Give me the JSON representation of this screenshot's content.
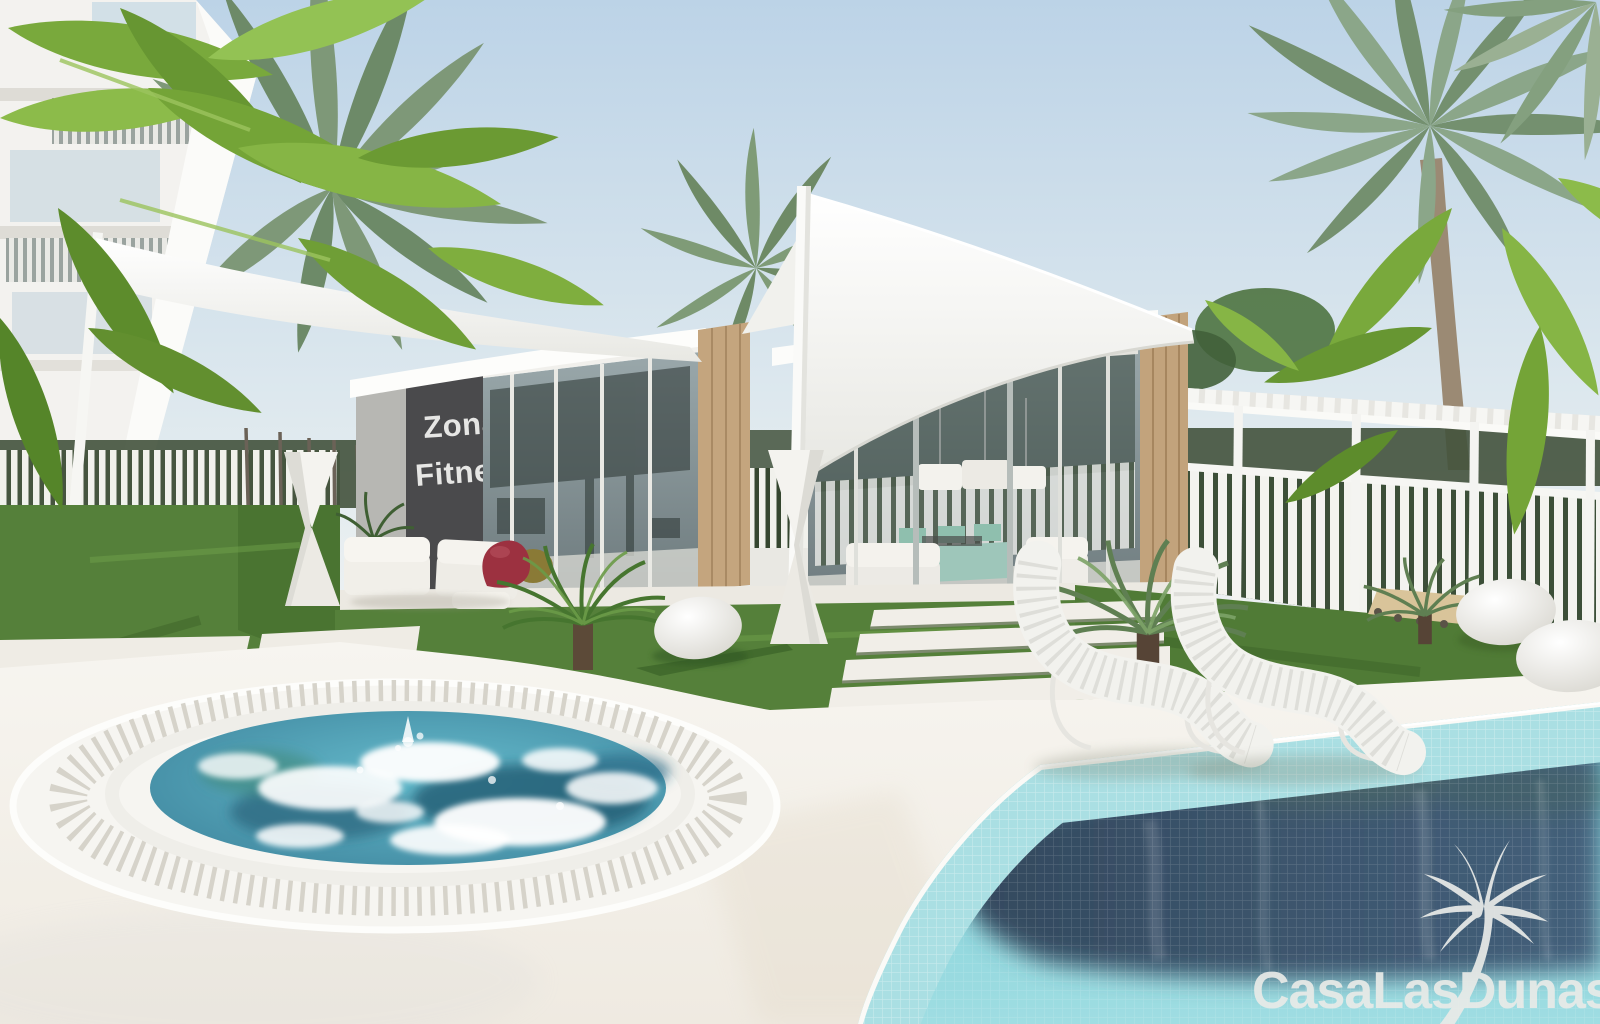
{
  "scene": {
    "description": "3D architectural render of a resort garden: modern glass pavilions with white sail canopies, palm trees, a bubbling round jacuzzi and a mosaic-tiled swimming pool",
    "elements": [
      "sky",
      "apartment-building",
      "banana-foliage",
      "palm-trees",
      "sail-canopies",
      "zona-fitness-pavilion",
      "lounge-pavilion",
      "pergola",
      "picket-fences",
      "lawn",
      "stepping-stones",
      "jacuzzi",
      "swimming-pool",
      "lounge-chairs",
      "pebble-sculptures",
      "hourglass-planters",
      "watermark-logo"
    ]
  },
  "sign": {
    "line1": "Zona",
    "line2": "Fitness",
    "panel_color": "#4a4a4c",
    "text_color": "#e6e6e4"
  },
  "watermark": {
    "text": "CasaLasDunas",
    "icon": "palm-tree-icon",
    "color": "#e9ebe8"
  },
  "palette": {
    "sky_top": "#c2d7e8",
    "sky_horizon": "#eaf0f2",
    "canopy_white": "#fafaf8",
    "wood": "#c4a57e",
    "grass": "#55803a",
    "deck": "#f5f3ee",
    "jacuzzi_water": "#4fa8bd",
    "jacuzzi_foam": "#ffffff",
    "pool_water_dark": "#3c5468",
    "pool_tile_turquoise": "#66c6d0",
    "pool_tile_light": "#aadfe3",
    "table_mint": "#9ec6ba",
    "beanbag_red": "#9c3140"
  }
}
